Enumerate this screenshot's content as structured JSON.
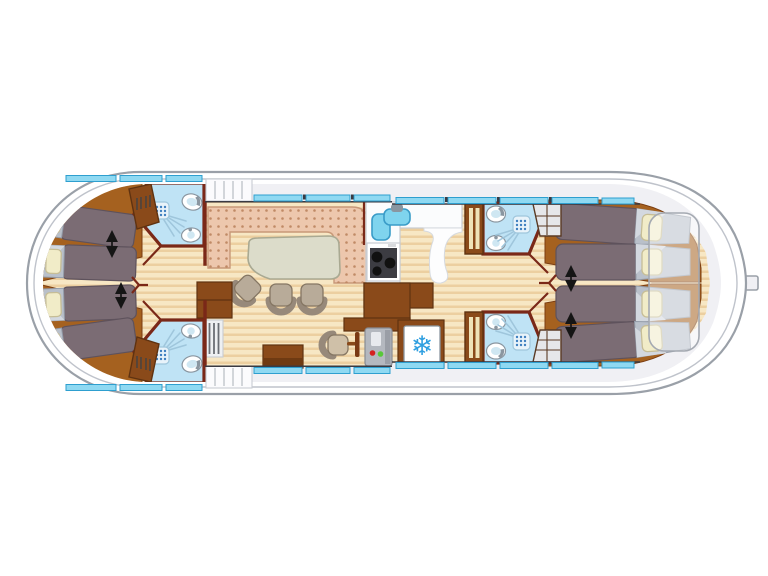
{
  "diagram": {
    "type": "houseboat-floor-plan",
    "view": "top-down",
    "berth_count": 8,
    "cabin_count": 4,
    "shower_room_count": 4
  },
  "icons": {
    "freezer": "❄"
  },
  "colors": {
    "hull_line": "#9aa0a8",
    "hull_fill": "#ffffff",
    "deck": "#f0f0f4",
    "deck_edge": "#bfc3cb",
    "wall": "#7a2818",
    "wall_dark_line": "#3a3a42",
    "wood_light": "#f7e7c4",
    "wood_stripe": "#eccfa0",
    "platform": "#a5611f",
    "platform_edge": "#7a3c10",
    "window_fill": "#8fd9f2",
    "window_edge": "#2e9fcf",
    "blanket": "#7b6c74",
    "blanket_edge": "#5e525c",
    "bed_head": "#b9c0ca",
    "bed_head_hi": "#d3d8df",
    "bed_head_edge": "#939ba8",
    "pillow": "#f1ecc8",
    "pillow_edge": "#c6bd96",
    "bath_floor": "#bfe3f5",
    "fixture": "#ffffff",
    "fixture_edge": "#8a96a0",
    "fixture_basin": "#cfe7f2",
    "shower_head": "#e8f3fa",
    "shower_dot": "#3f7fbf",
    "spray": "#9fc6dc",
    "sofa": "#edc7ad",
    "sofa_dot": "#c08a66",
    "sofa_edge": "#c89878",
    "table": "#dcdcca",
    "table_edge": "#a9a992",
    "chair": "#b8ab99",
    "chair_back": "#97897a",
    "chair_edge": "#857663",
    "cabinet": "#8a4a1a",
    "cabinet_edge": "#5f3210",
    "cream": "#efe3b8",
    "shelf_fill": "#e6e7ea",
    "shelf_frame": "#5a3a24",
    "counter": "#fbfcfd",
    "counter_edge": "#c8ccd2",
    "sink": "#7fd4ee",
    "sink_edge": "#3a9cc8",
    "stove_panel": "#3c3c42",
    "burner": "#111111",
    "helm_panel": "#b4b8bf",
    "indicator_red": "#d42020",
    "indicator_green": "#58c838",
    "snowflake": "#2f9fe0",
    "arrow": "#151515",
    "step_line": "#c8ccd2",
    "overlay_edge": "#a4a9b1"
  }
}
